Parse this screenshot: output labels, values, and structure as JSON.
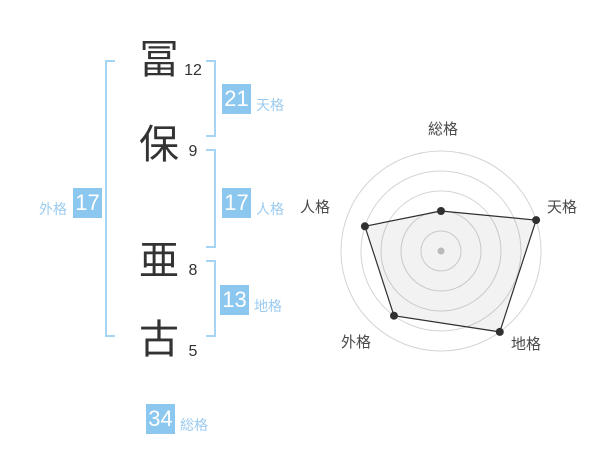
{
  "panel": {
    "name_display": {
      "characters": [
        {
          "char": "冨",
          "strokes": "12"
        },
        {
          "char": "保",
          "strokes": "9"
        },
        {
          "char": "亜",
          "strokes": "8"
        },
        {
          "char": "古",
          "strokes": "5"
        }
      ]
    },
    "badges": {
      "tenkaku": {
        "value": "21",
        "label": "天格"
      },
      "jinkaku": {
        "value": "17",
        "label": "人格"
      },
      "gaikaku": {
        "value": "17",
        "label": "外格"
      },
      "chikaku": {
        "value": "13",
        "label": "地格"
      },
      "soukaku": {
        "value": "34",
        "label": "総格"
      }
    }
  },
  "chart_data": {
    "type": "radar",
    "categories": [
      "総格",
      "天格",
      "地格",
      "外格",
      "人格"
    ],
    "values": [
      2,
      5,
      5,
      4,
      4
    ],
    "max": 5,
    "rings": 5,
    "grid": true,
    "legend": false,
    "title": ""
  },
  "colors": {
    "accent_blue": "#8bc7ef",
    "label_blue": "#9bcbf1",
    "bracket_blue": "#a6d4f3",
    "badge_text": "#ffffff",
    "text_dark": "#333333",
    "radar_grid": "#d4d4d4",
    "radar_center": "#c4c4c4",
    "radar_line": "#303030",
    "radar_fill": "rgba(0,0,0,0.05)",
    "radar_label": "#4a4a4a"
  }
}
